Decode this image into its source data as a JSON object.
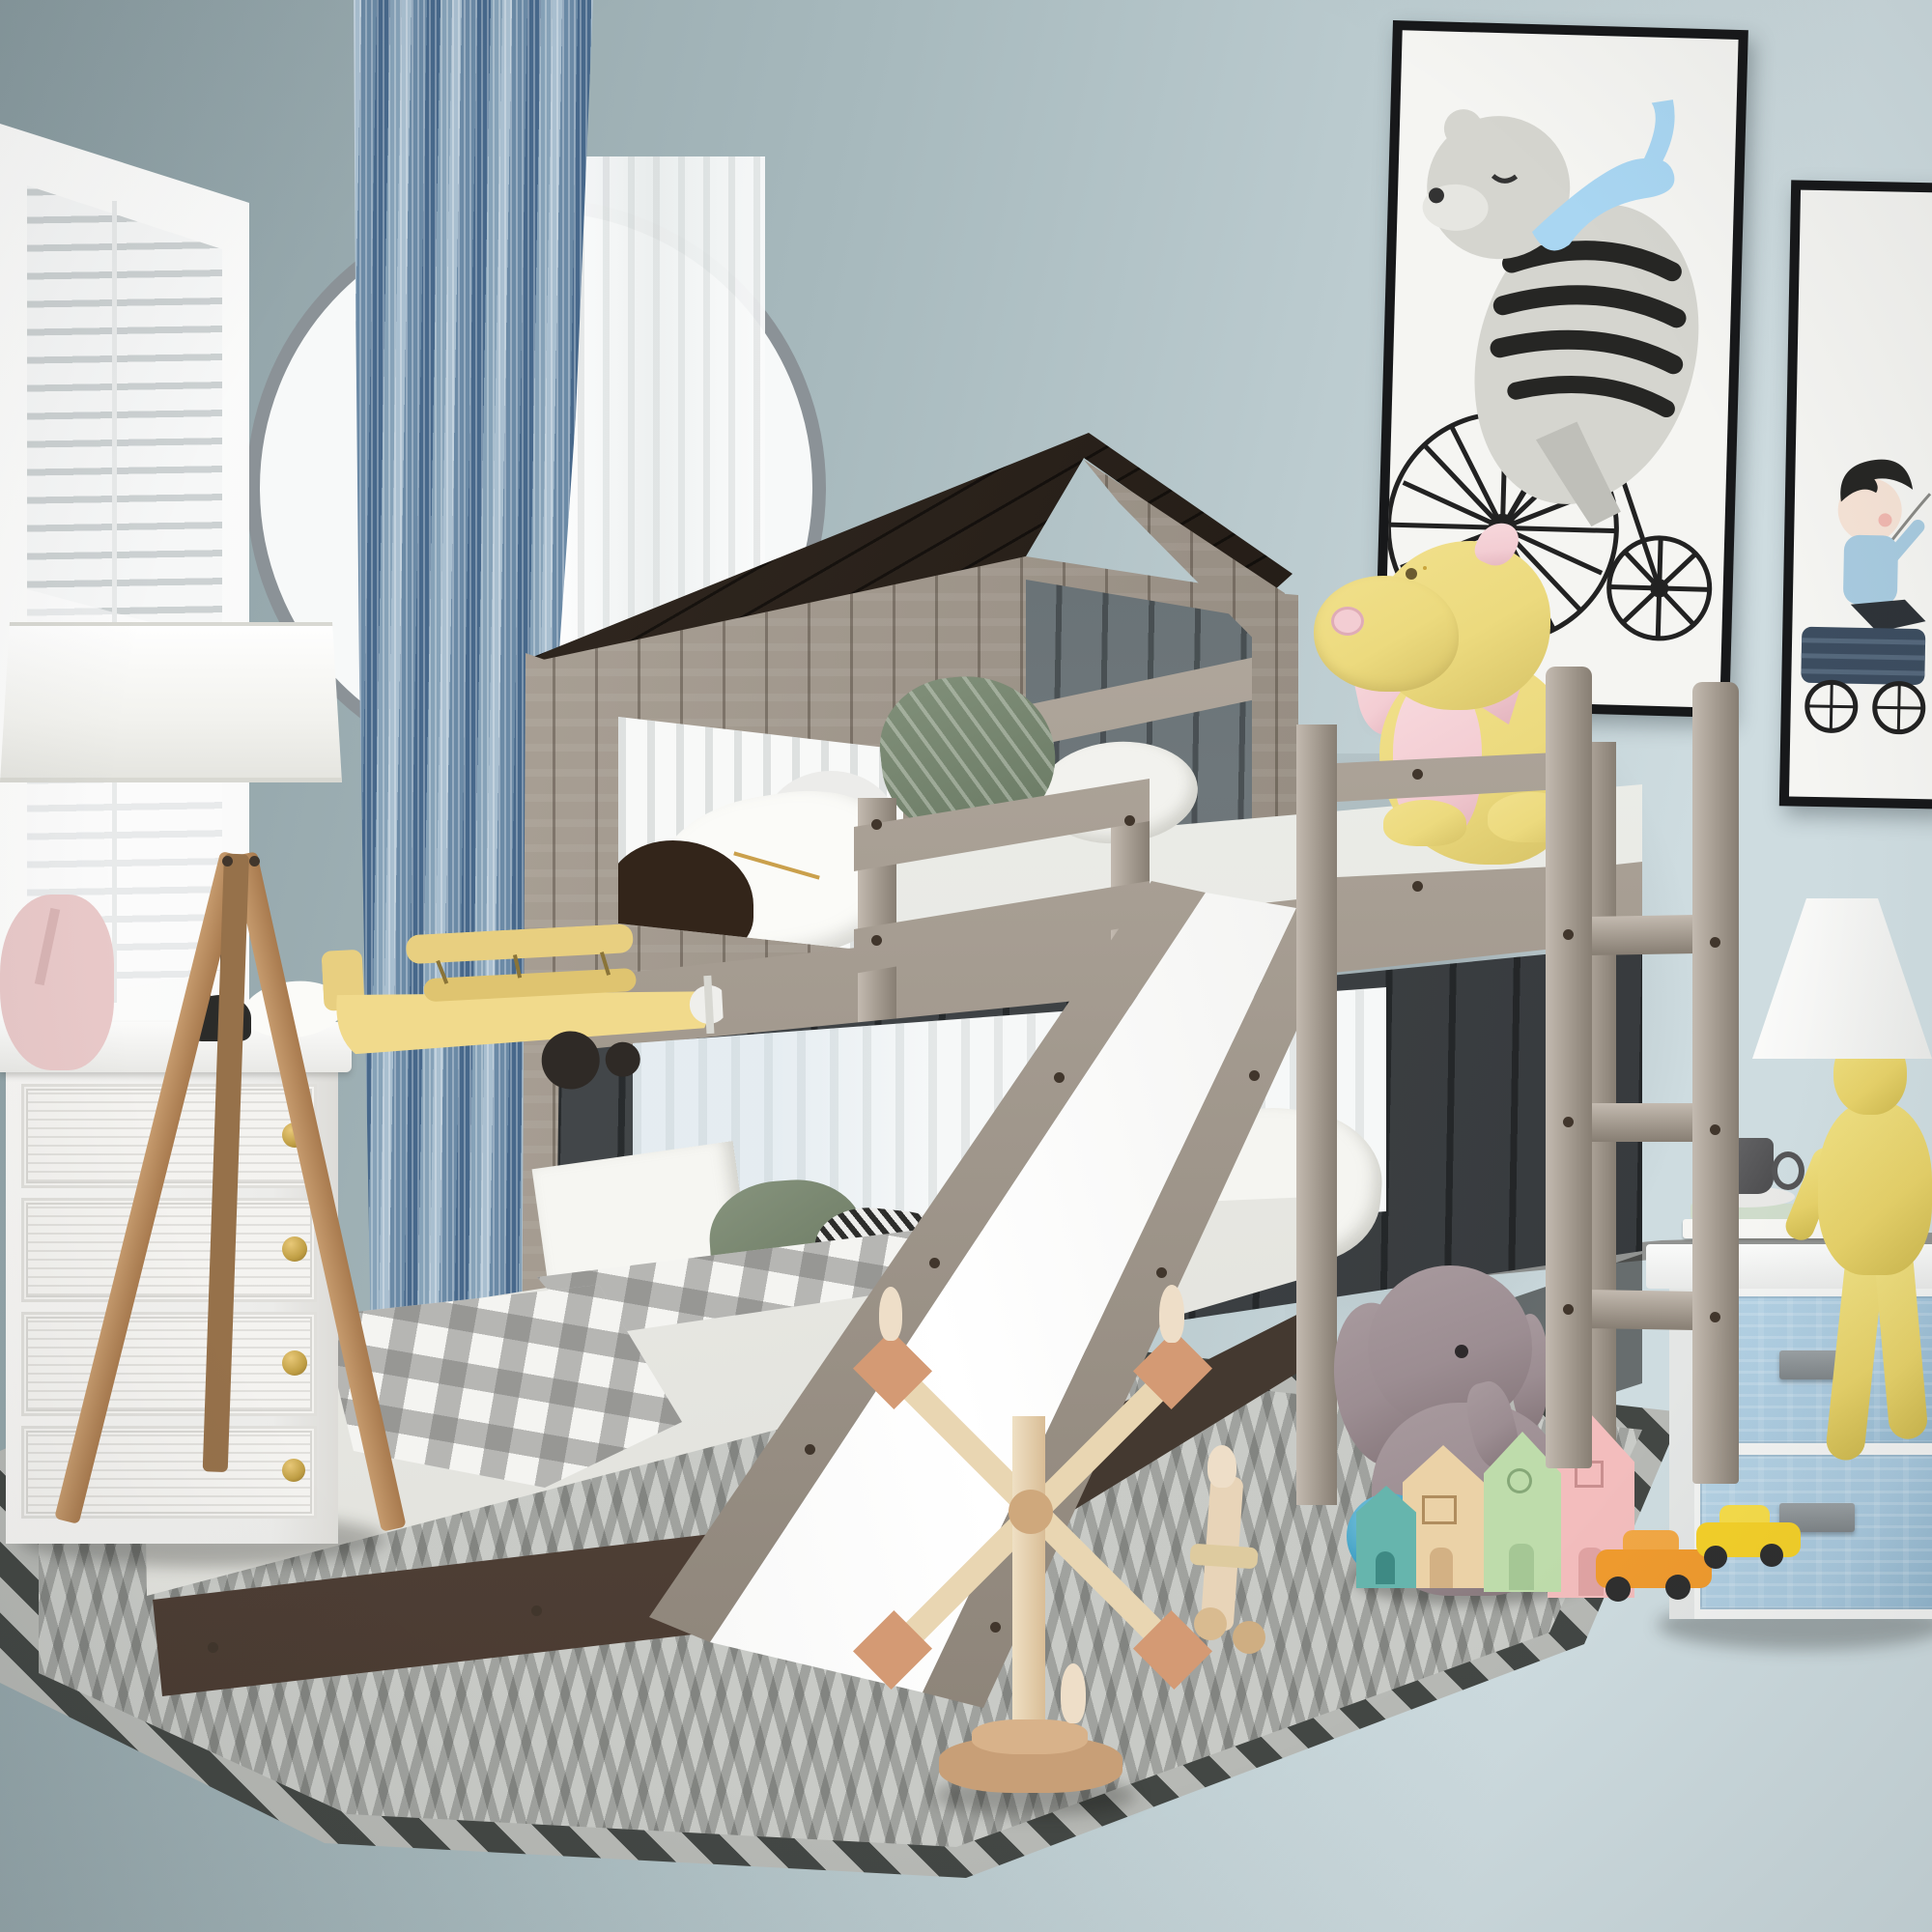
{
  "meta": {
    "title": "Children's bedroom product photo — wood playhouse bunk bed (twin-over-full) with roof, slide and ladder",
    "type": "product-photograph",
    "text_on_screen": "none"
  },
  "colors": {
    "wallDark": "#8a9ca1",
    "wallMid": "#a7b9bd",
    "wallLight": "#cedce0",
    "archRim": "#8b9297",
    "blindGap": "#ccd1d2",
    "posterFrame": "#17181a",
    "posterBg": "#f5f5f2",
    "woodHi": "#c3bab0",
    "wood": "#a89f94",
    "woodLo": "#877e73",
    "bolt": "#41362c",
    "dragonY": "#ecda7e",
    "dragonYd": "#d6c266",
    "dragonP": "#f3cdd3",
    "dragonPd": "#e2b2bc",
    "rugBase": "#c8cac6",
    "rugDark": "#434744",
    "hounds1": "#2d2d2b",
    "hounds2": "#ececea",
    "eleph": "#9c8d92",
    "ball": "#3fa0c4",
    "knob": "#c09f45",
    "drawerBlue": "#a8c8dd",
    "drawerBlueDk": "#8fb4cc",
    "figY": "#e6d169",
    "toyWoodDk": "#d49a74",
    "peg": "#eedec8",
    "hTeal": "#66b5ad",
    "hTan": "#ebd2a7",
    "hGreen": "#bedcab",
    "hPink": "#f3bdbd",
    "carOrange": "#f09b2e",
    "carYellow": "#f4d029",
    "bearGray": "#d5d5cf",
    "scarfBlue": "#a9d6f2",
    "boyShirt": "#a8cbe0",
    "wagonBlue": "#3c4d60",
    "planeYellow": "#f1da8c",
    "charcoalWall": "#3f4346",
    "roofDark": "#2a211b"
  },
  "objects": [
    {
      "name": "wall",
      "desc": "blue-gray painted wall, lighter toward right"
    },
    {
      "name": "wood-floor",
      "desc": "light oak plank floor laid diagonally"
    },
    {
      "name": "window",
      "desc": "left window with white frame and closed white venetian blinds"
    },
    {
      "name": "blue-curtain",
      "desc": "floor-length speckled blue curtain panel"
    },
    {
      "name": "arch-window",
      "desc": "round-top window with white sheer curtain behind bed"
    },
    {
      "name": "poster-bear",
      "desc": "framed print: gray bear in striped sweater and blue scarf riding penny-farthing bicycle"
    },
    {
      "name": "poster-boy",
      "desc": "framed print: boy in blue shirt riding a dark blue wagon"
    },
    {
      "name": "bunk-bed",
      "desc": "weathered gray wood playhouse loft bed: dark plank roof, plank gable with window, lower charcoal wall with window, twin top bunk with guardrails, full bottom bed, wooden slide, ladder"
    },
    {
      "name": "top-mattress",
      "desc": "white twin mattress with sage leaf pillow and white duvet roll"
    },
    {
      "name": "dragon-plush",
      "desc": "yellow plush dragon with pink belly, wings and button nostril sitting on top bunk"
    },
    {
      "name": "bottom-bed",
      "desc": "full-size mattress on dark espresso platform with white+sage+houndstooth pillows and gray buffalo-plaid throw"
    },
    {
      "name": "slide",
      "desc": "angled wooden slide with white sliding surface and black bolts"
    },
    {
      "name": "ladder",
      "desc": "gray wood ladder leaning at right front"
    },
    {
      "name": "rug",
      "desc": "gray chevron/herringbone area rug with dark zigzag border"
    },
    {
      "name": "dresser",
      "desc": "white reeded 4-drawer chest with brass knobs"
    },
    {
      "name": "tripod-lamp",
      "desc": "wood tripod floor lamp with white drum shade"
    },
    {
      "name": "toy-biplane",
      "desc": "yellow toy biplane on dresser top"
    },
    {
      "name": "wire-toy",
      "desc": "small black wire toy on dresser top"
    },
    {
      "name": "pink-plush",
      "desc": "pink plush/bag at far left on dresser"
    },
    {
      "name": "elephant-plush",
      "desc": "gray plush elephant sitting under bed by ladder"
    },
    {
      "name": "blue-ball",
      "desc": "teal rubber ball"
    },
    {
      "name": "wood-houses",
      "desc": "four painted wooden toy houses: teal, tan, green, pink"
    },
    {
      "name": "toy-cars",
      "desc": "orange and yellow toy sports cars"
    },
    {
      "name": "windmill-toy",
      "desc": "wooden windmill/ferris toy with peg dolls"
    },
    {
      "name": "peg-car-toy",
      "desc": "small natural-wood peg car toy"
    },
    {
      "name": "nightstand",
      "desc": "white nightstand with two pale-blue embossed fabric drawers and gray handles"
    },
    {
      "name": "figure-lamp",
      "desc": "mustard-yellow sitting-man table lamp with white cone shade"
    },
    {
      "name": "cup-and-books",
      "desc": "dark gray cup on saucer atop two books on nightstand"
    }
  ]
}
